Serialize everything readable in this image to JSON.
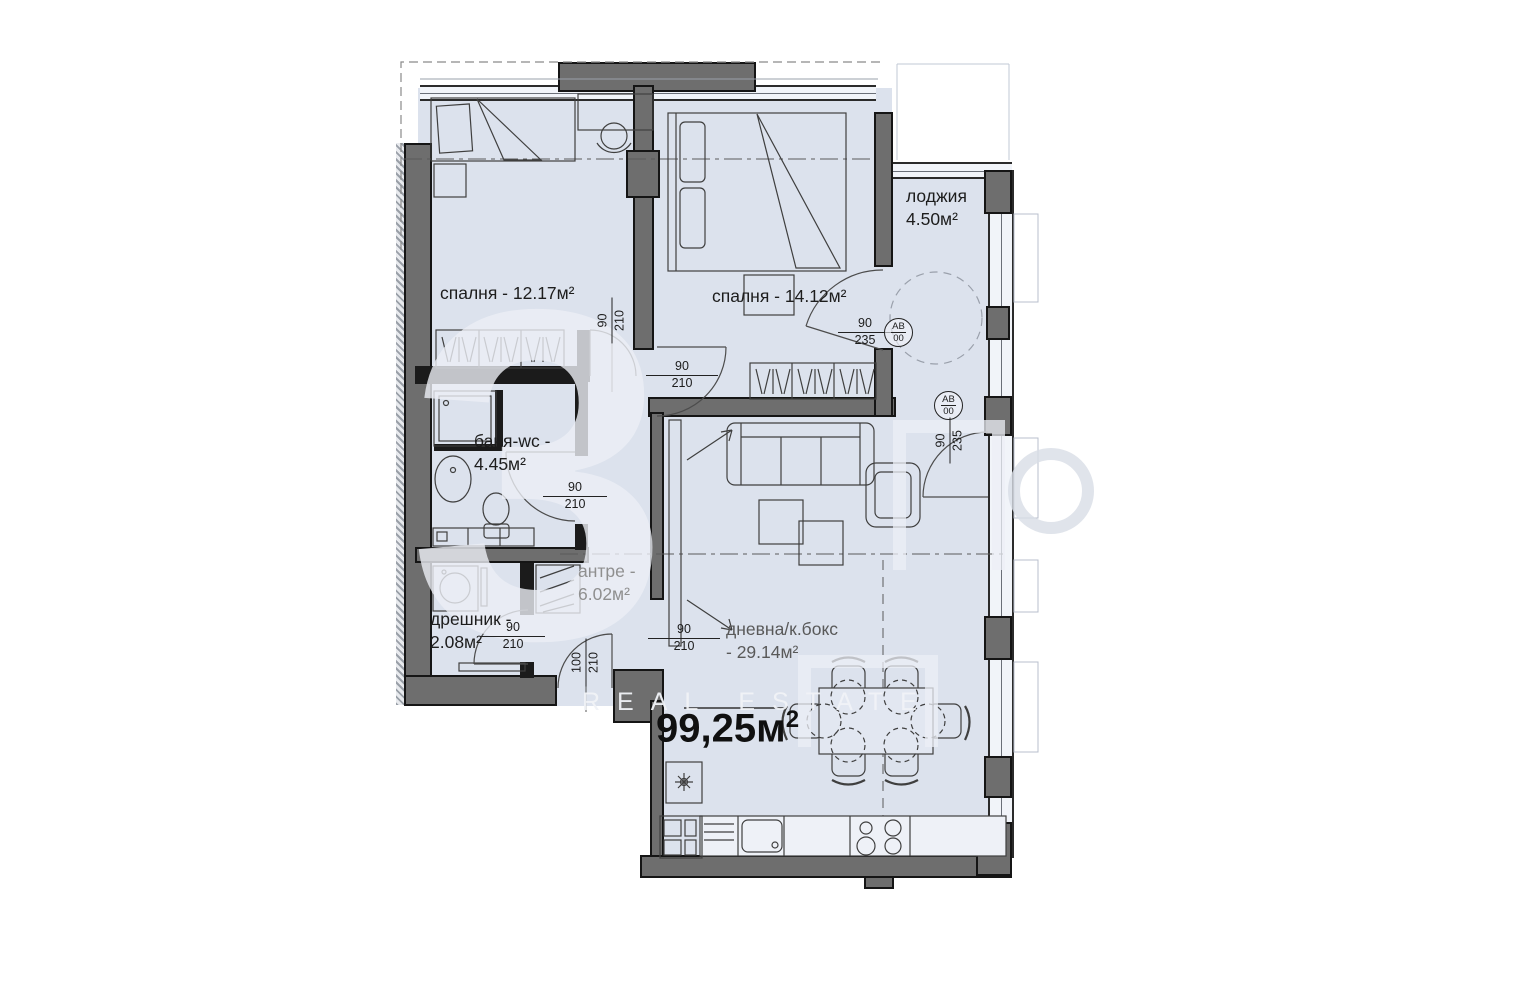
{
  "rooms": {
    "bedroom1": {
      "line1": "спалня - 12.17м²"
    },
    "bedroom2": {
      "line1": "спалня - 14.12м²"
    },
    "loggia": {
      "line1": "лоджия",
      "line2": "4.50м²"
    },
    "bathroom": {
      "line1": "баня-wc -",
      "line2": "4.45м²"
    },
    "closet": {
      "line1": "дрешник -",
      "line2": "2.08м²"
    },
    "hallway": {
      "line1": "антре -",
      "line2": "6.02м²"
    },
    "living": {
      "line1": "дневна/к.бокс",
      "line2": "- 29.14м²"
    }
  },
  "total_area": {
    "value": "99,25м",
    "sup": "2"
  },
  "dimensions": {
    "bedroom1_door": {
      "w": "90",
      "h": "210"
    },
    "bedroom2_door": {
      "w": "90",
      "h": "210"
    },
    "bedroom2_loggia_door": {
      "w": "90",
      "h": "235"
    },
    "living_terrace_door": {
      "w": "90",
      "h": "235"
    },
    "bathroom_door": {
      "w": "90",
      "h": "210"
    },
    "closet_door": {
      "w": "90",
      "h": "210"
    },
    "entry_door": {
      "w": "100",
      "h": "210"
    },
    "living_door": {
      "w": "90",
      "h": "210"
    }
  },
  "door_tag": {
    "line1": "АВ",
    "line2": "00"
  },
  "watermark": {
    "symbol": "3",
    "label": "REAL ESTATE"
  },
  "colors": {
    "floor": "#dce2ed",
    "wall_concrete": "#6e6e6e",
    "wall_partition": "#1b1b1b",
    "muted_label": "#8f8f8f"
  }
}
